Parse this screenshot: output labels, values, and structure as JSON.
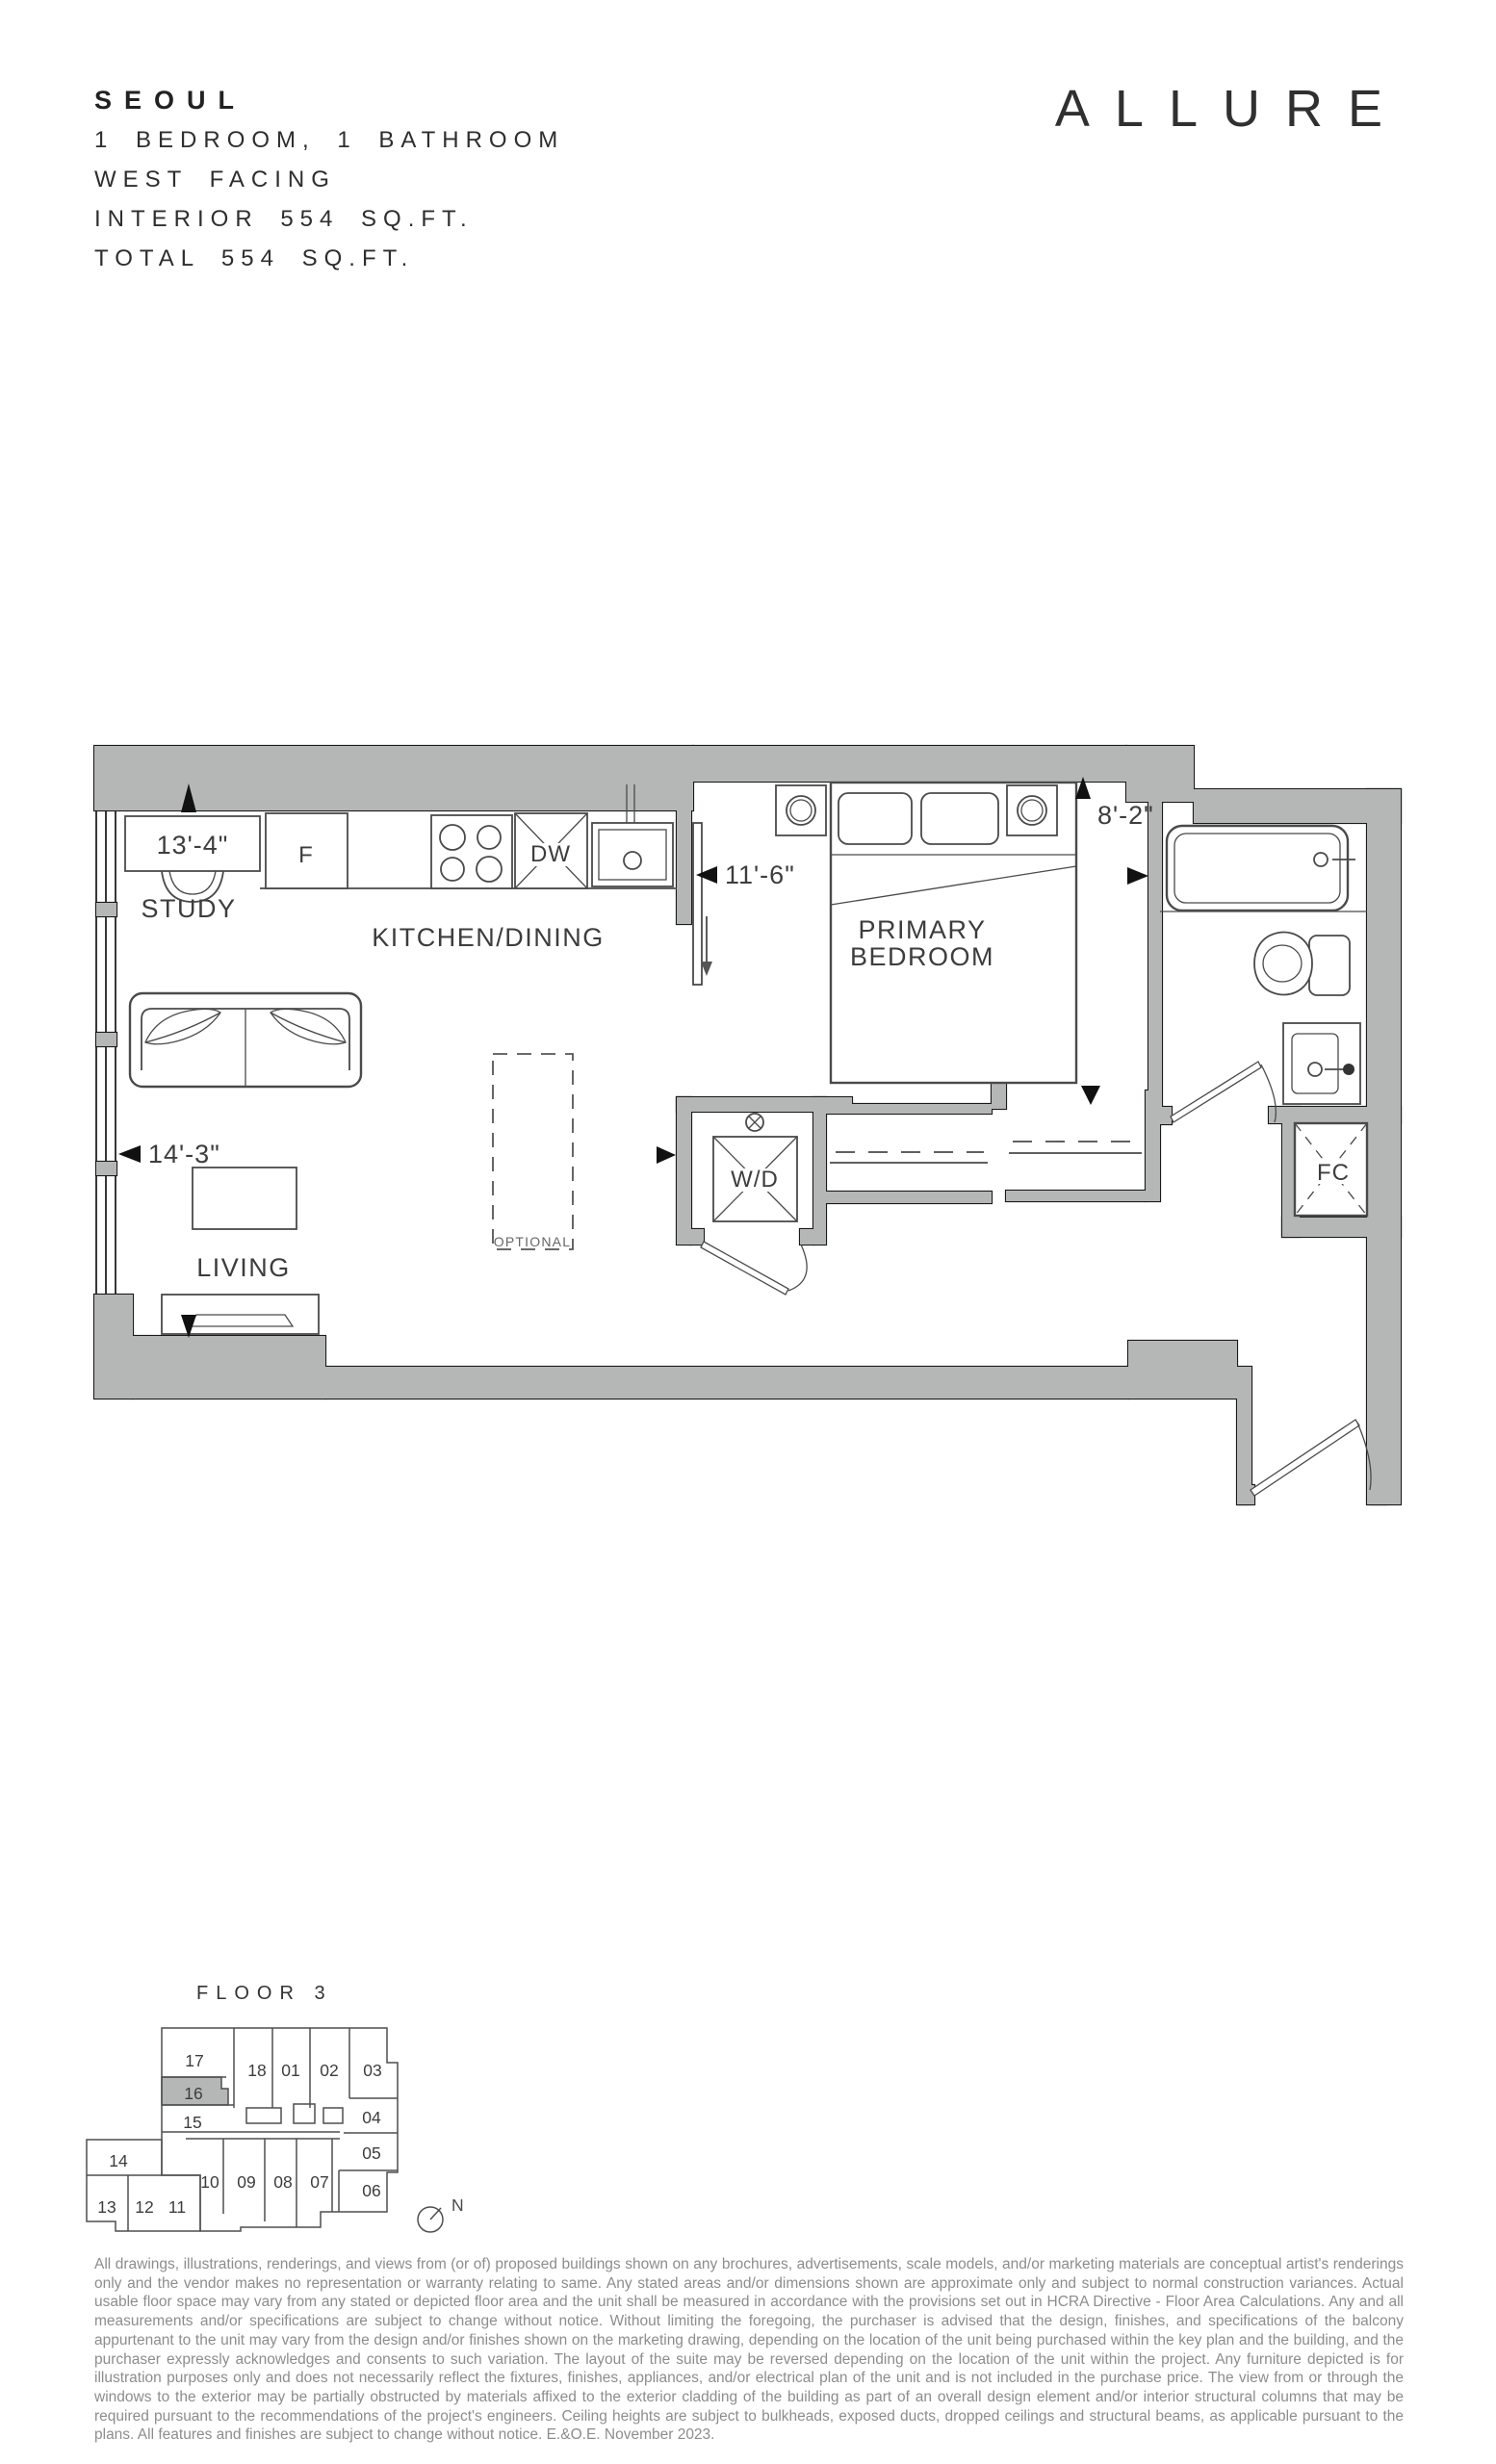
{
  "header": {
    "unit_name": "SEOUL",
    "specs": [
      "1 BEDROOM, 1 BATHROOM",
      "WEST FACING",
      "INTERIOR 554 SQ.FT.",
      "TOTAL 554 SQ.FT."
    ],
    "brand": "ALLURE"
  },
  "floorplan": {
    "labels": {
      "study": "STUDY",
      "kitchen_dining": "KITCHEN/DINING",
      "living": "LIVING",
      "primary_line1": "PRIMARY",
      "primary_line2": "BEDROOM",
      "washer_dryer": "W/D",
      "fan_coil": "FC",
      "optional": "OPTIONAL",
      "fridge": "F",
      "dishwasher": "DW"
    },
    "dimensions": {
      "study_width": "13'-4\"",
      "kitchen_width": "11'-6\"",
      "living_width": "14'-3\"",
      "bedroom_width": "8'-2\""
    }
  },
  "keyplan": {
    "title": "FLOOR 3",
    "highlighted_unit": "16",
    "north_label": "N",
    "units": [
      "17",
      "18",
      "01",
      "02",
      "03",
      "16",
      "15",
      "04",
      "05",
      "14",
      "10",
      "09",
      "08",
      "07",
      "06",
      "13",
      "12",
      "11"
    ]
  },
  "disclaimer": "All drawings, illustrations, renderings, and views from (or of) proposed buildings shown on any brochures, advertisements, scale models, and/or marketing materials are conceptual artist's renderings only and the vendor makes no representation or warranty relating to same. Any stated areas and/or dimensions shown are approximate only and subject to normal construction variances. Actual usable floor space may vary from any stated or depicted floor area and the unit shall be measured in accordance with the provisions set out in HCRA Directive - Floor Area Calculations. Any and all measurements and/or specifications are subject to change without notice. Without limiting the foregoing, the purchaser is advised that the design, finishes, and specifications of the balcony appurtenant to the unit may vary from the design and/or finishes shown on the marketing drawing, depending on the location of the unit being purchased within the key plan and the building, and the purchaser expressly acknowledges and consents to such variation. The layout of the suite may be reversed depending on the location of the unit within the project. Any furniture depicted is for illustration purposes only and does not necessarily reflect the fixtures, finishes, appliances, and/or electrical plan of the unit and is not included in the purchase price. The view from or through the windows to the exterior may be partially obstructed by materials affixed to the exterior cladding of the building as part of an overall design element and/or interior structural columns that may be required pursuant to the recommendations of the project's engineers. Ceiling heights are subject to bulkheads, exposed ducts, dropped ceilings and structural beams, as applicable pursuant to the plans. All features and finishes are subject to change without notice. E.&O.E. November 2023."
}
